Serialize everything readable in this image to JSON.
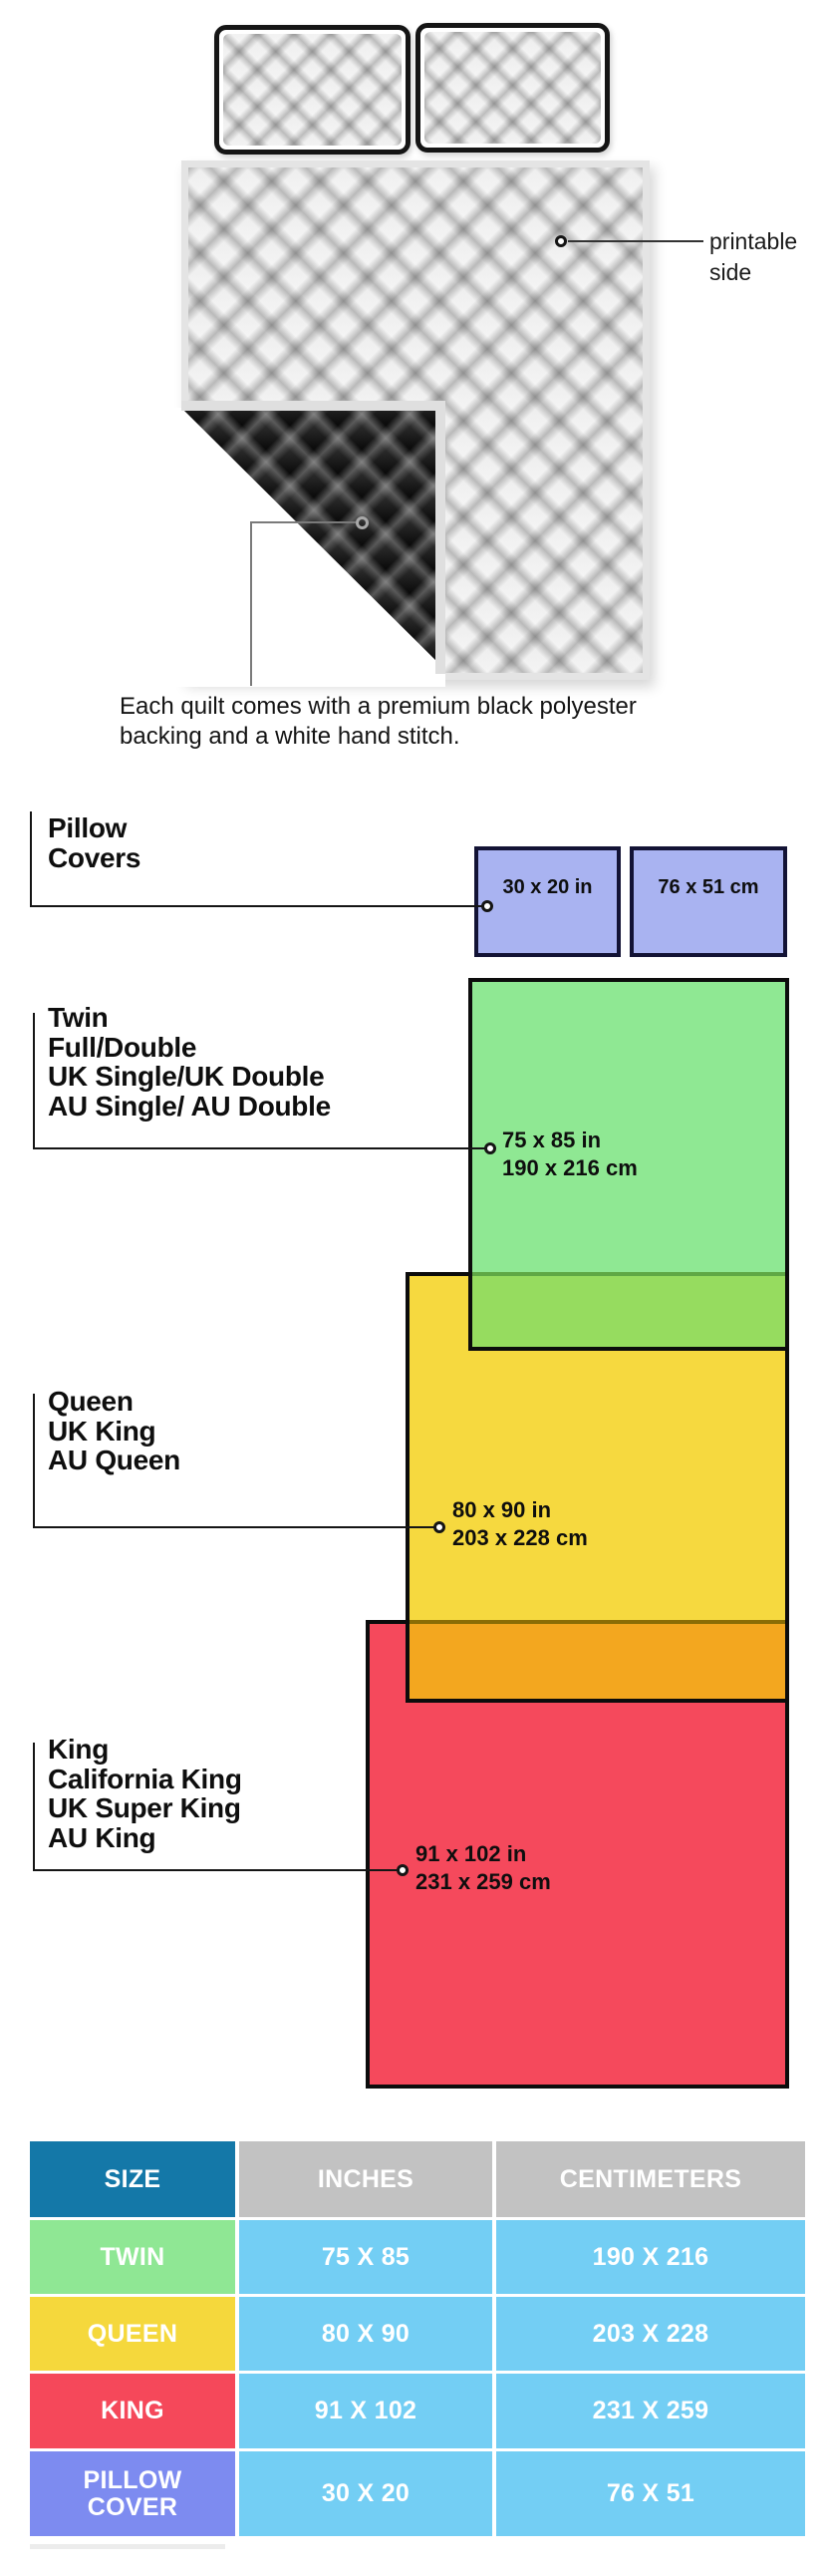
{
  "illustration": {
    "printable_side": [
      "printable",
      "side"
    ],
    "caption": [
      "Each quilt comes with a premium black polyester",
      "backing and a white hand stitch."
    ]
  },
  "diagram": {
    "pillow": {
      "labels": [
        "Pillow",
        "Covers"
      ],
      "size_in": "30 x 20 in",
      "size_cm": "76 x 51 cm"
    },
    "twin": {
      "labels": [
        "Twin",
        "Full/Double",
        "UK Single/UK Double",
        "AU Single/ AU Double"
      ],
      "size_in": "75 x 85 in",
      "size_cm": "190 x 216 cm"
    },
    "queen": {
      "labels": [
        "Queen",
        "UK King",
        "AU Queen"
      ],
      "size_in": "80 x 90 in",
      "size_cm": "203 x 228 cm"
    },
    "king": {
      "labels": [
        "King",
        "California King",
        "UK Super King",
        "AU King"
      ],
      "size_in": "91 x 102 in",
      "size_cm": "231 x 259 cm"
    }
  },
  "table": {
    "headers": [
      "SIZE",
      "INCHES",
      "CENTIMETERS"
    ],
    "rows": [
      {
        "size": "TWIN",
        "inches": "75 X 85",
        "centimeters": "190 X 216"
      },
      {
        "size": "QUEEN",
        "inches": "80 X 90",
        "centimeters": "203 X 228"
      },
      {
        "size": "KING",
        "inches": "91 X 102",
        "centimeters": "231 X 259"
      },
      {
        "size": "PILLOW COVER",
        "inches": "30 X 20",
        "centimeters": "76 X 51"
      }
    ]
  },
  "colors": {
    "diagram": {
      "pillow_fill": "#A9B3F1",
      "twin_fill": "#8FE893",
      "twin_overlap": "#96DC5F",
      "queen_fill": "#F6D93F",
      "queen_overlap": "#F3A71F",
      "king_fill": "#F5495C",
      "rect_border": "#0C0C0C"
    },
    "table": {
      "header_size": "#1478A8",
      "header_other": "#C2C2C2",
      "value_cell": "#73CEF4",
      "twin": "#8FE794",
      "queen": "#F5D83C",
      "king": "#F5485A",
      "pillow_cover": "#7D8BF0"
    },
    "quilt_backing": "#0A0A0A",
    "quilt_binding": "#E4E4E4"
  }
}
